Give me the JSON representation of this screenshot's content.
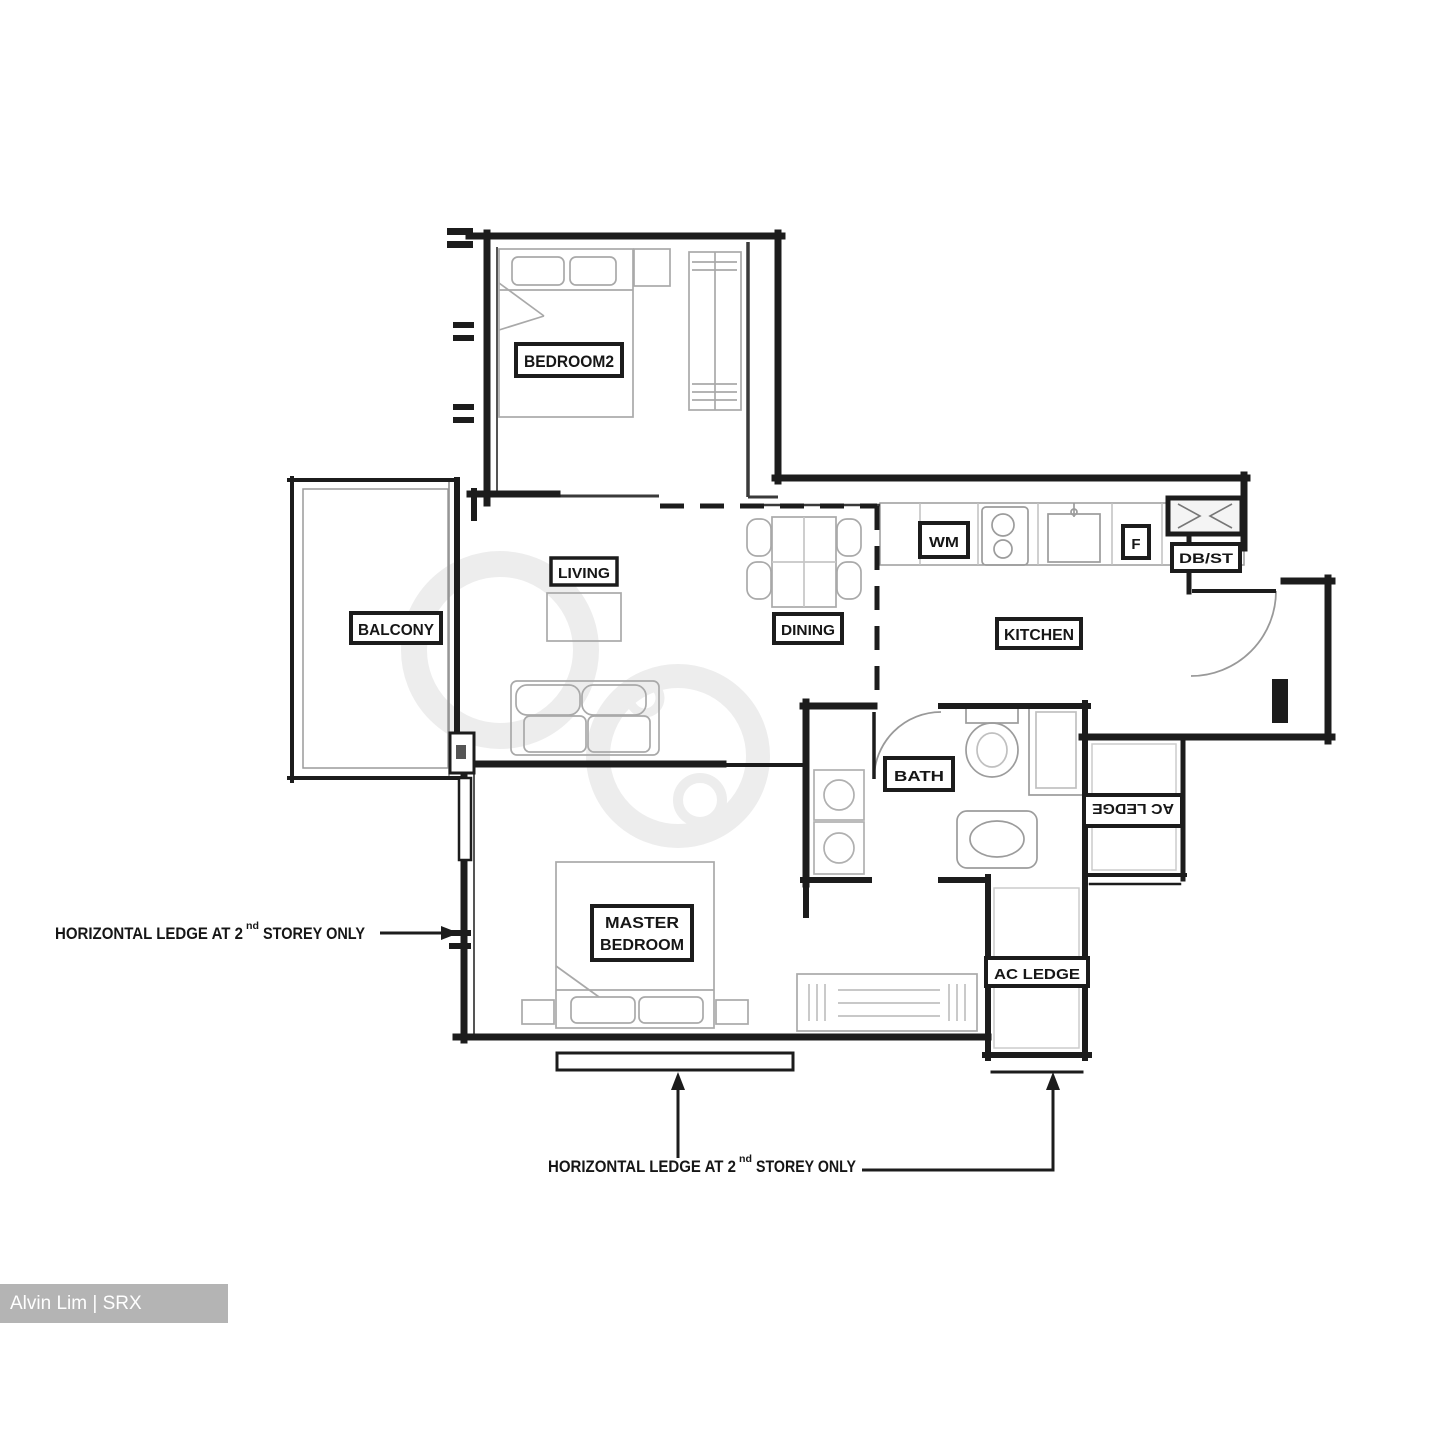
{
  "credit_bar": {
    "text": "Alvin Lim | SRX PROPERTY",
    "bg_color": "#b4b4b4",
    "text_color": "#ffffff"
  },
  "plan": {
    "rooms": {
      "bedroom2": "BEDROOM2",
      "balcony": "BALCONY",
      "living": "LIVING",
      "dining": "DINING",
      "kitchen": "KITCHEN",
      "bath": "BATH",
      "master_bedroom_line1": "MASTER",
      "master_bedroom_line2": "BEDROOM",
      "ac_ledge_bottom": "AC LEDGE",
      "ac_ledge_side": "AC LEDGE"
    },
    "fixtures": {
      "washing_machine": "WM",
      "fridge": "F",
      "db_store": "DB/ST"
    },
    "annotations": {
      "left": {
        "prefix": "HORIZONTAL LEDGE AT 2",
        "superscript": "nd",
        "suffix": "STOREY ONLY"
      },
      "bottom": {
        "prefix": "HORIZONTAL LEDGE AT 2",
        "superscript": "nd",
        "suffix": "STOREY ONLY"
      }
    },
    "colors": {
      "wall": "#1c1c1c",
      "thin_wall": "#555555",
      "furniture": "#a9a9a9",
      "label_bg": "#ffffff",
      "watermark_gray": "#ededed"
    }
  }
}
